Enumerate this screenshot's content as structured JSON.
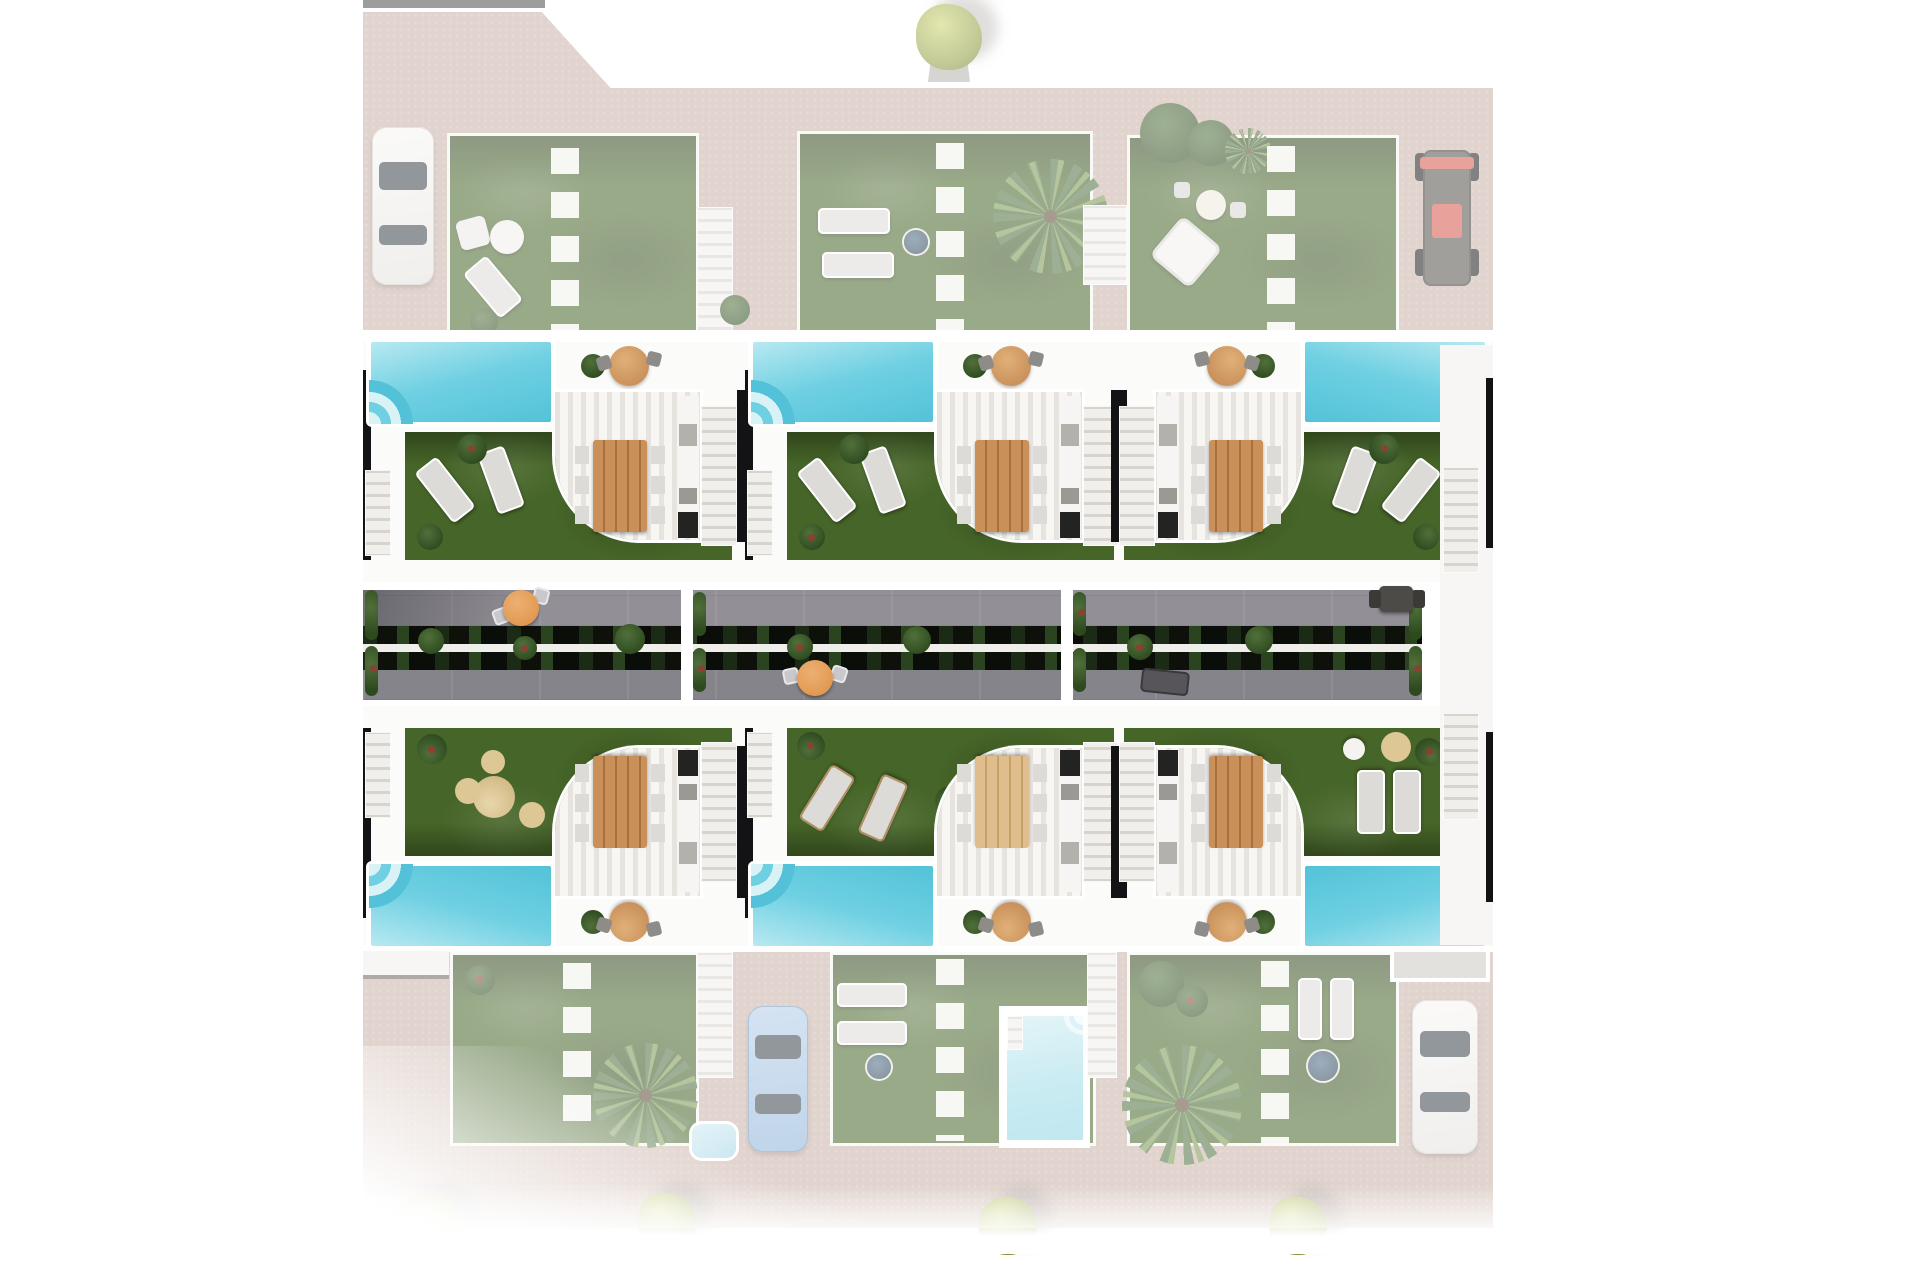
{
  "meta": {
    "type": "architectural_site_plan_render",
    "view": "top-down aerial 3D render",
    "description": "Residential development: two mirrored rows of three terraced villas, each with private pool, artificial lawn, pergola dining terrace and side stairs; central courtyard walkway with planter beds; faded north and south street bands with rear gardens, parking and trees"
  },
  "colors": {
    "pav": "#c8b0a5",
    "pavline": "#b5aba1",
    "lawn": "#466528",
    "poolhi": "#b8e9f1",
    "poolmid": "#6fd0e2",
    "poollo": "#53c2d8",
    "poolpale": "#d9f2f6",
    "stripeA": "#f7f6f3",
    "stripeB": "#e7e4e0",
    "stairface": "#f1efeb",
    "stairline": "#d7d3cd",
    "grayA": "#929096",
    "grayB": "#86848b",
    "planter": "#0e100a",
    "plantA": "#2d4a1f",
    "plantB": "#50703a",
    "plantRed": "#8a4134",
    "wood": "#c9905a",
    "woodline": "#a86f3f",
    "orange": "#e29a52",
    "chair": "#dcdbd7",
    "trellis": "#131315",
    "bushA": "#ccd36f",
    "bushB": "#8c9a3c",
    "palmA": "#4e6f3e",
    "palmB": "#79954f",
    "carblue": "#8cb2d8",
    "buggy": "#d5544a",
    "dkwin": "#394249",
    "white": "#ffffff",
    "offwhite": "#f0eeea",
    "wash": "rgba(255,255,255,0.45)"
  },
  "site": {
    "north_street_band": {
      "faded": true,
      "elements": [
        "white-car-parked",
        "rear-garden-west",
        "rear-garden-center",
        "rear-garden-east",
        "street-tree",
        "red-buggy-parked",
        "two-stair-paths",
        "stepping-stone-paths"
      ]
    },
    "villa_row_north": {
      "units": [
        {
          "id": "N-west",
          "pool_side": "west",
          "features": [
            "pool",
            "lawn",
            "two-loungers",
            "pergola-terrace",
            "dining-table-6-chairs",
            "outdoor-kitchen",
            "side-stairs",
            "round-patio-table"
          ]
        },
        {
          "id": "N-center",
          "pool_side": "west",
          "features": [
            "pool",
            "lawn",
            "two-loungers",
            "pergola-terrace",
            "dining-table-6-chairs",
            "outdoor-kitchen",
            "side-stairs",
            "round-patio-table"
          ]
        },
        {
          "id": "N-east",
          "pool_side": "east",
          "mirrored": true,
          "features": [
            "pool",
            "lawn",
            "two-loungers",
            "pergola-terrace",
            "dining-table-6-chairs",
            "outdoor-kitchen",
            "side-stairs",
            "round-patio-table"
          ]
        }
      ]
    },
    "courtyard": {
      "elements": [
        "paved-walkway-north",
        "paved-walkway-south",
        "double-planter-bed",
        "center-rail",
        "bistro-set-west",
        "bistro-set-south-center",
        "dark-bistro-set-east",
        "sun-lounger-east",
        "plant-columns-at-dividers"
      ]
    },
    "villa_row_south": {
      "units": [
        {
          "id": "S-west",
          "pool_side": "west",
          "mirrored_vertically": true
        },
        {
          "id": "S-center",
          "pool_side": "west",
          "mirrored_vertically": true
        },
        {
          "id": "S-east",
          "pool_side": "east",
          "mirrored_vertically": true,
          "mirrored": true
        }
      ]
    },
    "south_street_band": {
      "faded": true,
      "elements": [
        "rear-garden-west",
        "rear-garden-center-with-plunge-pool",
        "rear-garden-east",
        "blue-car-parked",
        "white-car-parked",
        "carport-roofs",
        "small-spa",
        "sidewalk-line",
        "four-street-shrubs",
        "palm-trees"
      ]
    }
  },
  "inventory": {
    "large_pools": 6,
    "plunge_pools": 1,
    "spas": 2,
    "dining_sets": 6,
    "bistro_sets": 4,
    "sun_loungers": 14,
    "palm_trees": 4,
    "street_tree_north": 1,
    "street_shrubs_south": 4,
    "cars": [
      {
        "color": "white",
        "location": "northwest-driveway"
      },
      {
        "color": "red",
        "type": "buggy",
        "location": "northeast-driveway"
      },
      {
        "color": "blue",
        "location": "south-center-driveway"
      },
      {
        "color": "white",
        "location": "southeast-driveway"
      }
    ]
  }
}
